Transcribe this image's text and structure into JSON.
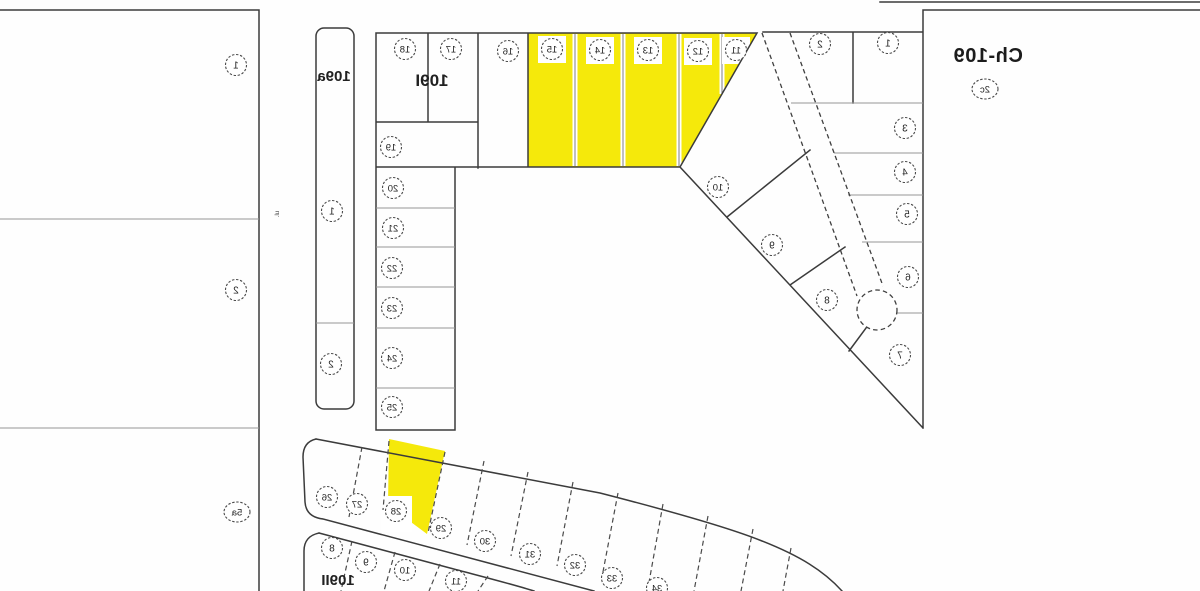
{
  "map": {
    "region": {
      "name": "Ch-109",
      "code": "2c"
    },
    "block_labels": [
      {
        "label": "109a"
      },
      {
        "label": "109I"
      },
      {
        "label": "109II"
      }
    ],
    "street_label": "ul.",
    "highlight_color": "#f5e90b",
    "line_color_strong": "#3b3b3b",
    "line_color_light": "#979797",
    "highlighted_lots": [
      "11",
      "12",
      "13",
      "14",
      "15",
      "28"
    ],
    "lots": [
      {
        "n": "1",
        "x": 236,
        "y": 65,
        "g": "left-parcel"
      },
      {
        "n": "2",
        "x": 236,
        "y": 290,
        "g": "left-parcel"
      },
      {
        "n": "5a",
        "x": 237,
        "y": 512,
        "g": "left-parcel",
        "big": true
      },
      {
        "n": "1",
        "x": 332,
        "y": 211,
        "g": "block-109a"
      },
      {
        "n": "2",
        "x": 331,
        "y": 364,
        "g": "block-109a"
      },
      {
        "n": "18",
        "x": 405,
        "y": 49,
        "g": "block-109I"
      },
      {
        "n": "17",
        "x": 451,
        "y": 49,
        "g": "block-109I"
      },
      {
        "n": "16",
        "x": 508,
        "y": 51,
        "g": "block-109I"
      },
      {
        "n": "15",
        "x": 552,
        "y": 49,
        "g": "block-109I",
        "halo": true
      },
      {
        "n": "14",
        "x": 600,
        "y": 50,
        "g": "block-109I",
        "halo": true
      },
      {
        "n": "13",
        "x": 648,
        "y": 50,
        "g": "block-109I",
        "halo": true
      },
      {
        "n": "12",
        "x": 698,
        "y": 51,
        "g": "block-109I",
        "halo": true
      },
      {
        "n": "11",
        "x": 736,
        "y": 50,
        "g": "block-109I",
        "halo": true
      },
      {
        "n": "19",
        "x": 391,
        "y": 147,
        "g": "block-109I"
      },
      {
        "n": "20",
        "x": 393,
        "y": 188,
        "g": "block-109I"
      },
      {
        "n": "21",
        "x": 393,
        "y": 228,
        "g": "block-109I"
      },
      {
        "n": "22",
        "x": 392,
        "y": 268,
        "g": "block-109I"
      },
      {
        "n": "23",
        "x": 392,
        "y": 308,
        "g": "block-109I"
      },
      {
        "n": "24",
        "x": 392,
        "y": 358,
        "g": "block-109I"
      },
      {
        "n": "25",
        "x": 392,
        "y": 407,
        "g": "block-109I"
      },
      {
        "n": "2",
        "x": 820,
        "y": 44,
        "g": "right-block"
      },
      {
        "n": "1",
        "x": 888,
        "y": 43,
        "g": "right-block"
      },
      {
        "n": "3",
        "x": 905,
        "y": 128,
        "g": "right-block"
      },
      {
        "n": "4",
        "x": 905,
        "y": 172,
        "g": "right-block"
      },
      {
        "n": "5",
        "x": 907,
        "y": 214,
        "g": "right-block"
      },
      {
        "n": "6",
        "x": 908,
        "y": 277,
        "g": "right-block"
      },
      {
        "n": "7",
        "x": 900,
        "y": 355,
        "g": "right-block"
      },
      {
        "n": "8",
        "x": 827,
        "y": 300,
        "g": "right-block"
      },
      {
        "n": "9",
        "x": 772,
        "y": 245,
        "g": "right-block"
      },
      {
        "n": "10",
        "x": 718,
        "y": 187,
        "g": "right-block"
      },
      {
        "n": "26",
        "x": 327,
        "y": 497,
        "g": "strip-upper"
      },
      {
        "n": "27",
        "x": 357,
        "y": 504,
        "g": "strip-upper"
      },
      {
        "n": "28",
        "x": 396,
        "y": 511,
        "g": "strip-upper",
        "halo": true
      },
      {
        "n": "29",
        "x": 441,
        "y": 528,
        "g": "strip-upper"
      },
      {
        "n": "30",
        "x": 485,
        "y": 541,
        "g": "strip-upper"
      },
      {
        "n": "31",
        "x": 530,
        "y": 554,
        "g": "strip-upper"
      },
      {
        "n": "32",
        "x": 575,
        "y": 565,
        "g": "strip-upper"
      },
      {
        "n": "33",
        "x": 612,
        "y": 578,
        "g": "strip-upper"
      },
      {
        "n": "34",
        "x": 657,
        "y": 588,
        "g": "strip-upper"
      },
      {
        "n": "8",
        "x": 332,
        "y": 548,
        "g": "block-109II"
      },
      {
        "n": "9",
        "x": 366,
        "y": 562,
        "g": "block-109II"
      },
      {
        "n": "10",
        "x": 405,
        "y": 570,
        "g": "block-109II"
      },
      {
        "n": "11",
        "x": 456,
        "y": 581,
        "g": "block-109II"
      },
      {
        "n": "2c",
        "x": 985,
        "y": 89,
        "g": "region-code",
        "big": true
      }
    ]
  }
}
